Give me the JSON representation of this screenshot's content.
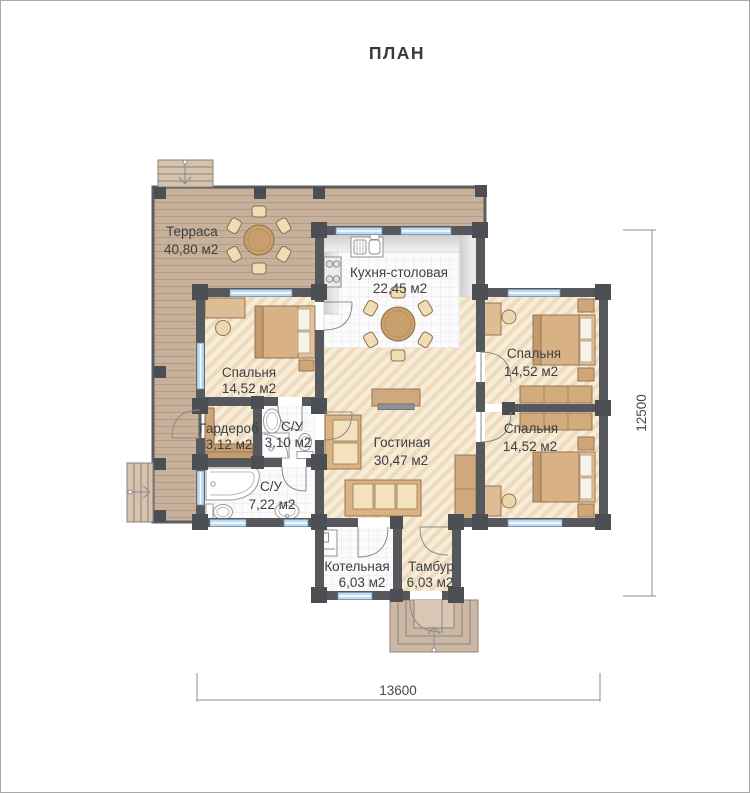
{
  "title": "ПЛАН",
  "plan": {
    "rooms": {
      "terrace": {
        "name": "Терраса",
        "area": "40,80 м2"
      },
      "kitchen": {
        "name": "Кухня-столовая",
        "area": "22,45 м2"
      },
      "bedroom1": {
        "name": "Спальня",
        "area": "14,52 м2"
      },
      "bedroom2": {
        "name": "Спальня",
        "area": "14,52 м2"
      },
      "bedroom3": {
        "name": "Спальня",
        "area": "14,52 м2"
      },
      "wardrobe": {
        "name": "Гардероб",
        "area": "3,12 м2"
      },
      "bathroom_small": {
        "name": "С/У",
        "area": "3,10 м2"
      },
      "bathroom_large": {
        "name": "С/У",
        "area": "7,22 м2"
      },
      "living": {
        "name": "Гостиная",
        "area": "30,47 м2"
      },
      "boiler": {
        "name": "Котельная",
        "area": "6,03 м2"
      },
      "vestibule": {
        "name": "Тамбур",
        "area": "6,03 м2"
      }
    },
    "dimensions": {
      "width": "13600",
      "height": "12500"
    },
    "palette": {
      "wall": "#55595e",
      "post": "#4b4f54",
      "terrace_deck": "#c8b19b",
      "floor_hatch": "#f7ecd8",
      "hatch_stripe": "#eddbbc",
      "tile": "#fbfbfb",
      "window_glass": "#bcdaf2",
      "furniture_wood": "#d9b286",
      "cushion": "#f3e2bd",
      "fixture_white": "#ffffff",
      "dimension_line": "#8f8f8f",
      "label_text": "#3c3f42"
    }
  }
}
